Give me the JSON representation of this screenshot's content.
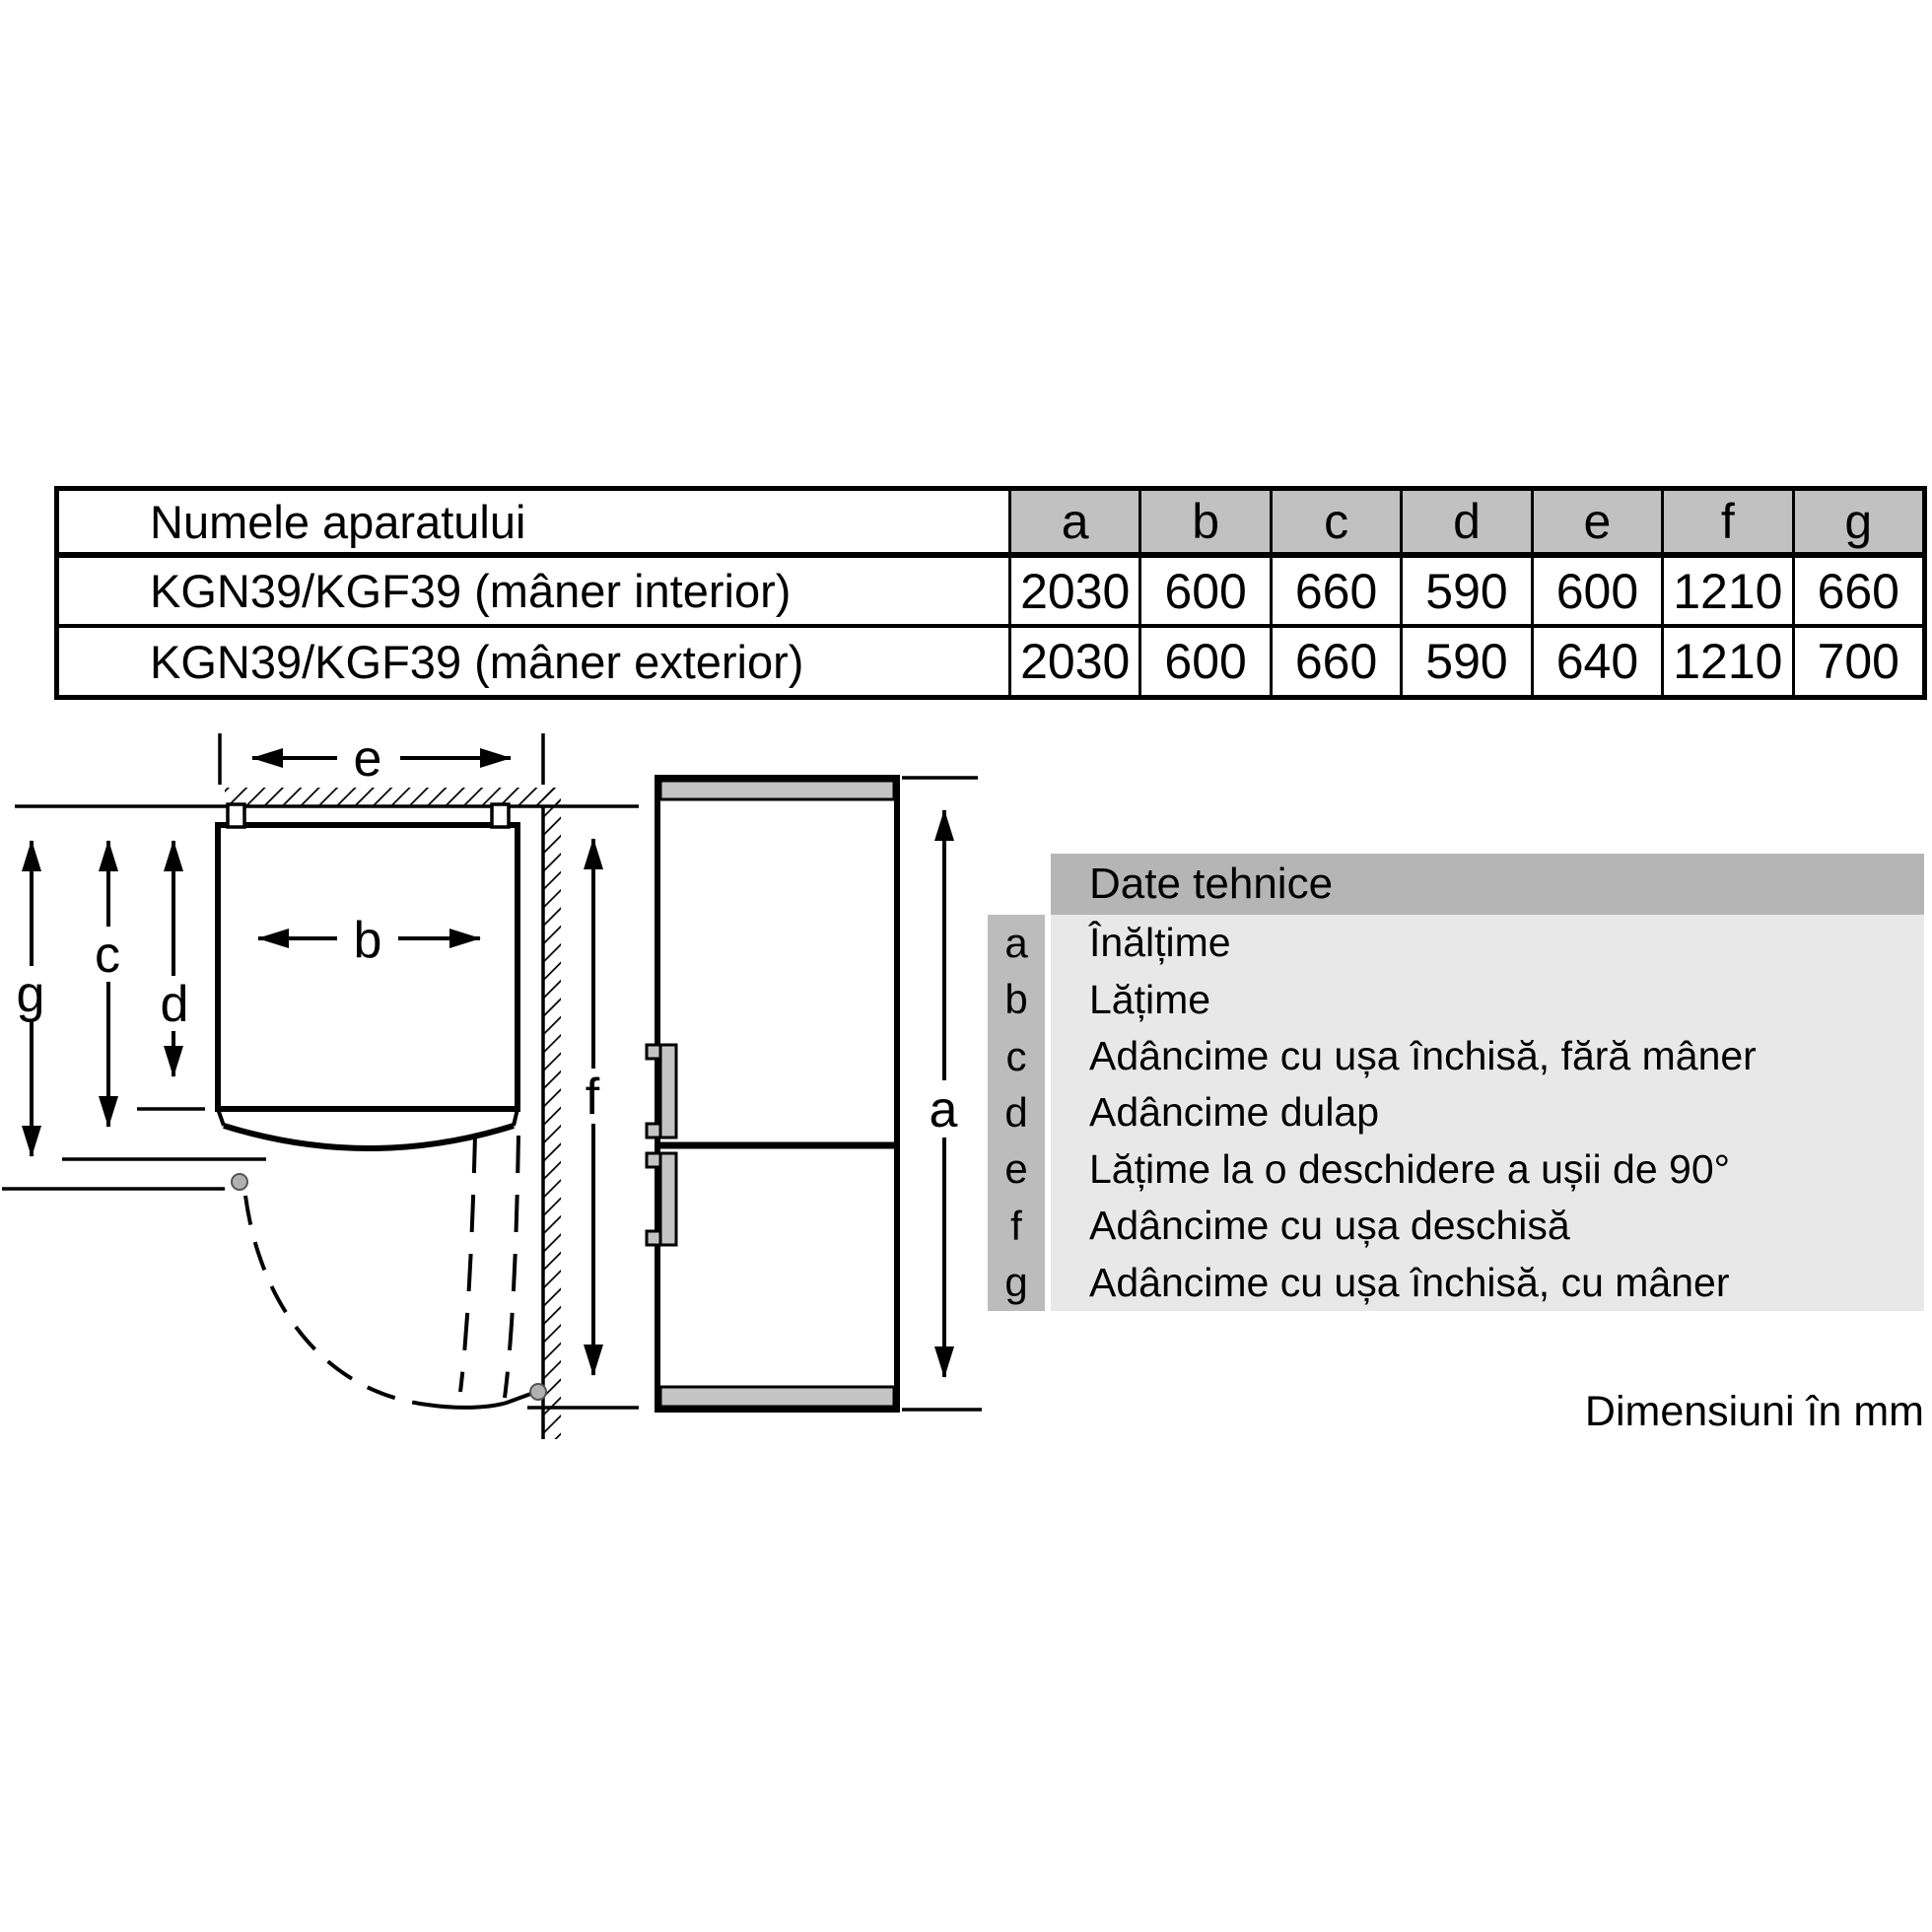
{
  "table": {
    "name_header": "Numele aparatului",
    "dim_headers": [
      "a",
      "b",
      "c",
      "d",
      "e",
      "f",
      "g"
    ],
    "rows": [
      {
        "name": "KGN39/KGF39 (mâner interior)",
        "values": [
          "2030",
          "600",
          "660",
          "590",
          "600",
          "1210",
          "660"
        ]
      },
      {
        "name": "KGN39/KGF39 (mâner exterior)",
        "values": [
          "2030",
          "600",
          "660",
          "590",
          "640",
          "1210",
          "700"
        ]
      }
    ]
  },
  "legend": {
    "title": "Date tehnice",
    "items": [
      {
        "key": "a",
        "label": "Înălțime"
      },
      {
        "key": "b",
        "label": "Lățime"
      },
      {
        "key": "c",
        "label": "Adâncime cu ușa închisă, fără mâner"
      },
      {
        "key": "d",
        "label": "Adâncime dulap"
      },
      {
        "key": "e",
        "label": "Lățime la o deschidere a ușii de 90°"
      },
      {
        "key": "f",
        "label": "Adâncime cu ușa deschisă"
      },
      {
        "key": "g",
        "label": "Adâncime cu ușa închisă, cu mâner"
      }
    ]
  },
  "diagram": {
    "labels": {
      "a": "a",
      "b": "b",
      "c": "c",
      "d": "d",
      "e": "e",
      "f": "f",
      "g": "g"
    }
  },
  "footer": {
    "units_note": "Dimensiuni în mm"
  },
  "colors": {
    "line": "#000000",
    "table_header_bg": "#c1c1c1",
    "legend_title_bg": "#b5b5b5",
    "legend_key_bg": "#bcbcbc",
    "legend_row_bg": "#e8e8e8",
    "fridge_band": "#c4c4c4",
    "hinge_dot": "#b0b0b0"
  }
}
